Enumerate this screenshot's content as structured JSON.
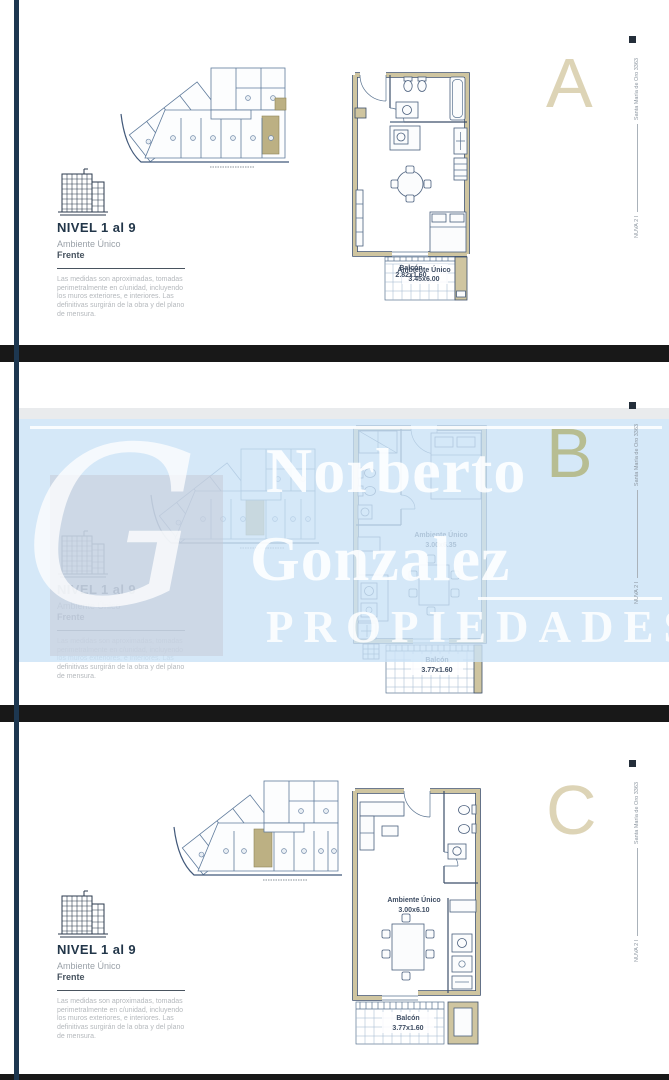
{
  "document": {
    "address_caption": "Santa María de Oro 3363",
    "project_caption": "NUVA 2 I"
  },
  "watermark": {
    "monogram": "G",
    "name_line1": "Norberto",
    "name_line2": "Gonzalez",
    "tagline": "PROPIEDADES"
  },
  "shared": {
    "level_title": "NIVEL 1 al 9",
    "unit_type": "Ambiente Único",
    "orientation": "Frente",
    "disclaimer": [
      "Las medidas son aproximadas, tomadas",
      "perimetralmente en c/unidad, incluyendo",
      "los muros exteriores,  e interiores. Las",
      "definitivas surgirán de la obra y del plano",
      "de mensura."
    ]
  },
  "panels": [
    {
      "letter": "A",
      "room_label": "Ambiente Único",
      "room_dims": "3.45x6.00",
      "balcony_label": "Balcón",
      "balcony_dims": "2.82x1.60"
    },
    {
      "letter": "B",
      "room_label": "Ambiente Único",
      "room_dims": "3.00x6.35",
      "balcony_label": "Balcón",
      "balcony_dims": "3.77x1.60"
    },
    {
      "letter": "C",
      "room_label": "Ambiente Único",
      "room_dims": "3.00x6.10",
      "balcony_label": "Balcón",
      "balcony_dims": "3.77x1.60"
    }
  ],
  "colors": {
    "navy_rule": "#1d3750",
    "wall_tan": "#cfc5a0",
    "highlight_tan": "#bcb083",
    "letter_beige": "#ddd4b6",
    "letter_olive": "#b7bd92",
    "watermark_band": "#cbe2f6"
  }
}
